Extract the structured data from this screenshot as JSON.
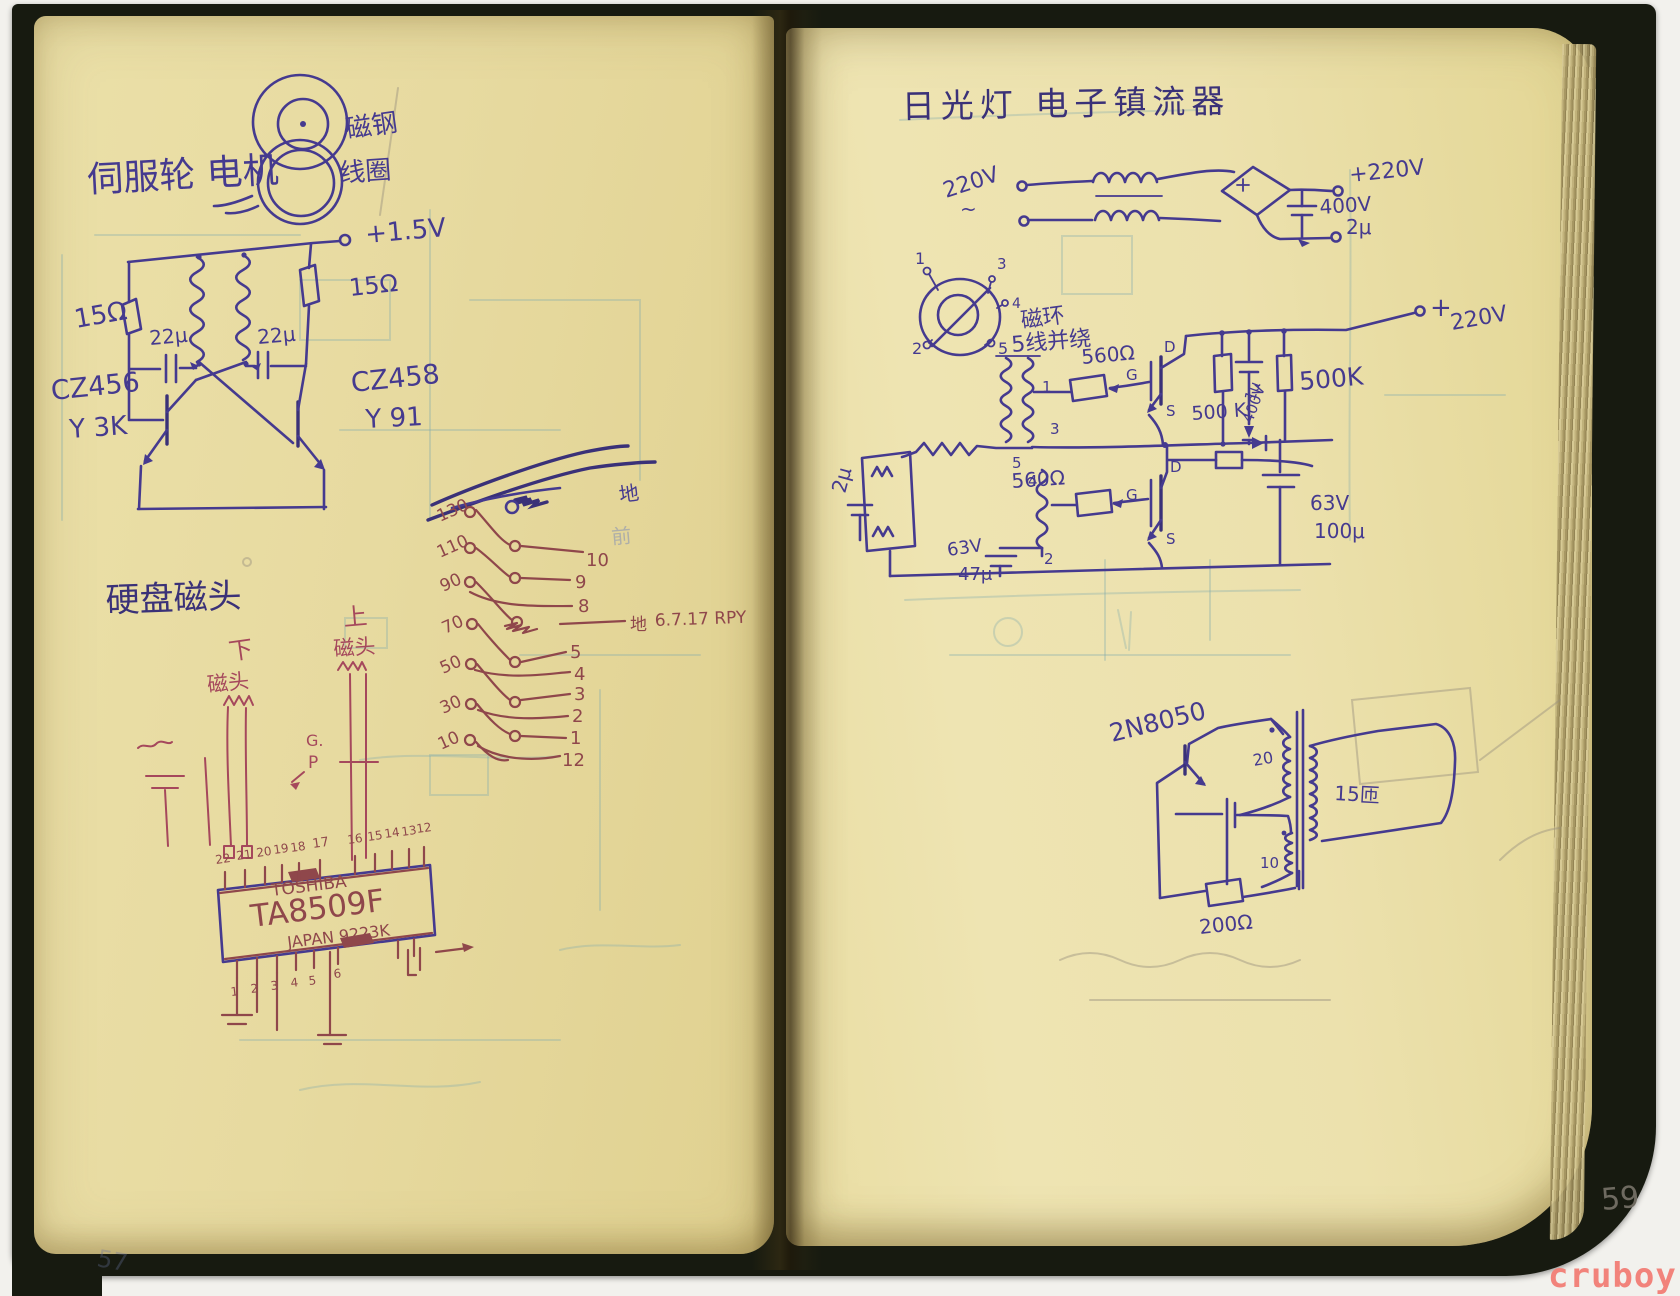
{
  "page": {
    "number": "59",
    "number_faint": "57",
    "watermark": "cruboy"
  },
  "left_page": {
    "motor": {
      "title": "伺服轮 电机",
      "magnet": "磁钢",
      "coil": "线圈",
      "supply": "+1.5V",
      "r1": "15Ω",
      "r2": "15Ω",
      "c1": "22μ",
      "c2": "22μ",
      "q1": "CZ456",
      "q1_gain": "Y 3K",
      "q2": "CZ458",
      "q2_gain": "Y 91"
    },
    "head": {
      "title": "硬盘磁头",
      "lower1": "下",
      "lower2": "磁头",
      "upper1": "上",
      "upper2": "磁头",
      "g": "G.",
      "p": "P"
    },
    "ic": {
      "brand": "TOSHIBA",
      "part": "TA8509F",
      "origin": "JAPAN 9223K",
      "pins_top": [
        "22",
        "21",
        "20",
        "19",
        "18",
        "17",
        "16",
        "15",
        "14",
        "13",
        "12"
      ],
      "pins_bottom": [
        "1",
        "2",
        "3",
        "4",
        "5",
        "6"
      ]
    },
    "ribbon": {
      "left": [
        "130",
        "110",
        "90",
        "70",
        "50",
        "30",
        "10"
      ],
      "top1": "地",
      "top2": "前",
      "pins_a": [
        "10",
        "9",
        "8"
      ],
      "gnd": "地",
      "note": "6.7.17 RPY",
      "pins_b": [
        "5",
        "4",
        "3",
        "2",
        "1"
      ],
      "last": "12"
    }
  },
  "right_page": {
    "title": "日光灯 电子镇流器",
    "rect": {
      "v": "220V",
      "ac": "~",
      "out": "+220V",
      "cv": "400V",
      "cc": "2μ"
    },
    "toroid": {
      "l1": "磁环",
      "l2": "5线并绕",
      "pins": [
        "1",
        "3",
        "4",
        "5",
        "2"
      ]
    },
    "inv": {
      "plus": "+",
      "v": "220V",
      "r1": "560Ω",
      "r2": "560Ω",
      "pot": "500 K",
      "pot2": "500K",
      "c1a": "1μ",
      "c1b": "400V",
      "cin": "2μ",
      "c2a": "63V",
      "c2b": "47μ",
      "c3a": "63V",
      "c3b": "100μ",
      "d1": "D",
      "g1": "G",
      "s1": "S",
      "d2": "D",
      "g2": "G",
      "s2": "S",
      "w1": "1",
      "w3": "3",
      "w5": "5",
      "w4": "4",
      "w2": "2"
    },
    "out": {
      "q": "2N8050",
      "t20": "20",
      "t10": "10",
      "t15": "15匝",
      "r": "200Ω"
    }
  }
}
